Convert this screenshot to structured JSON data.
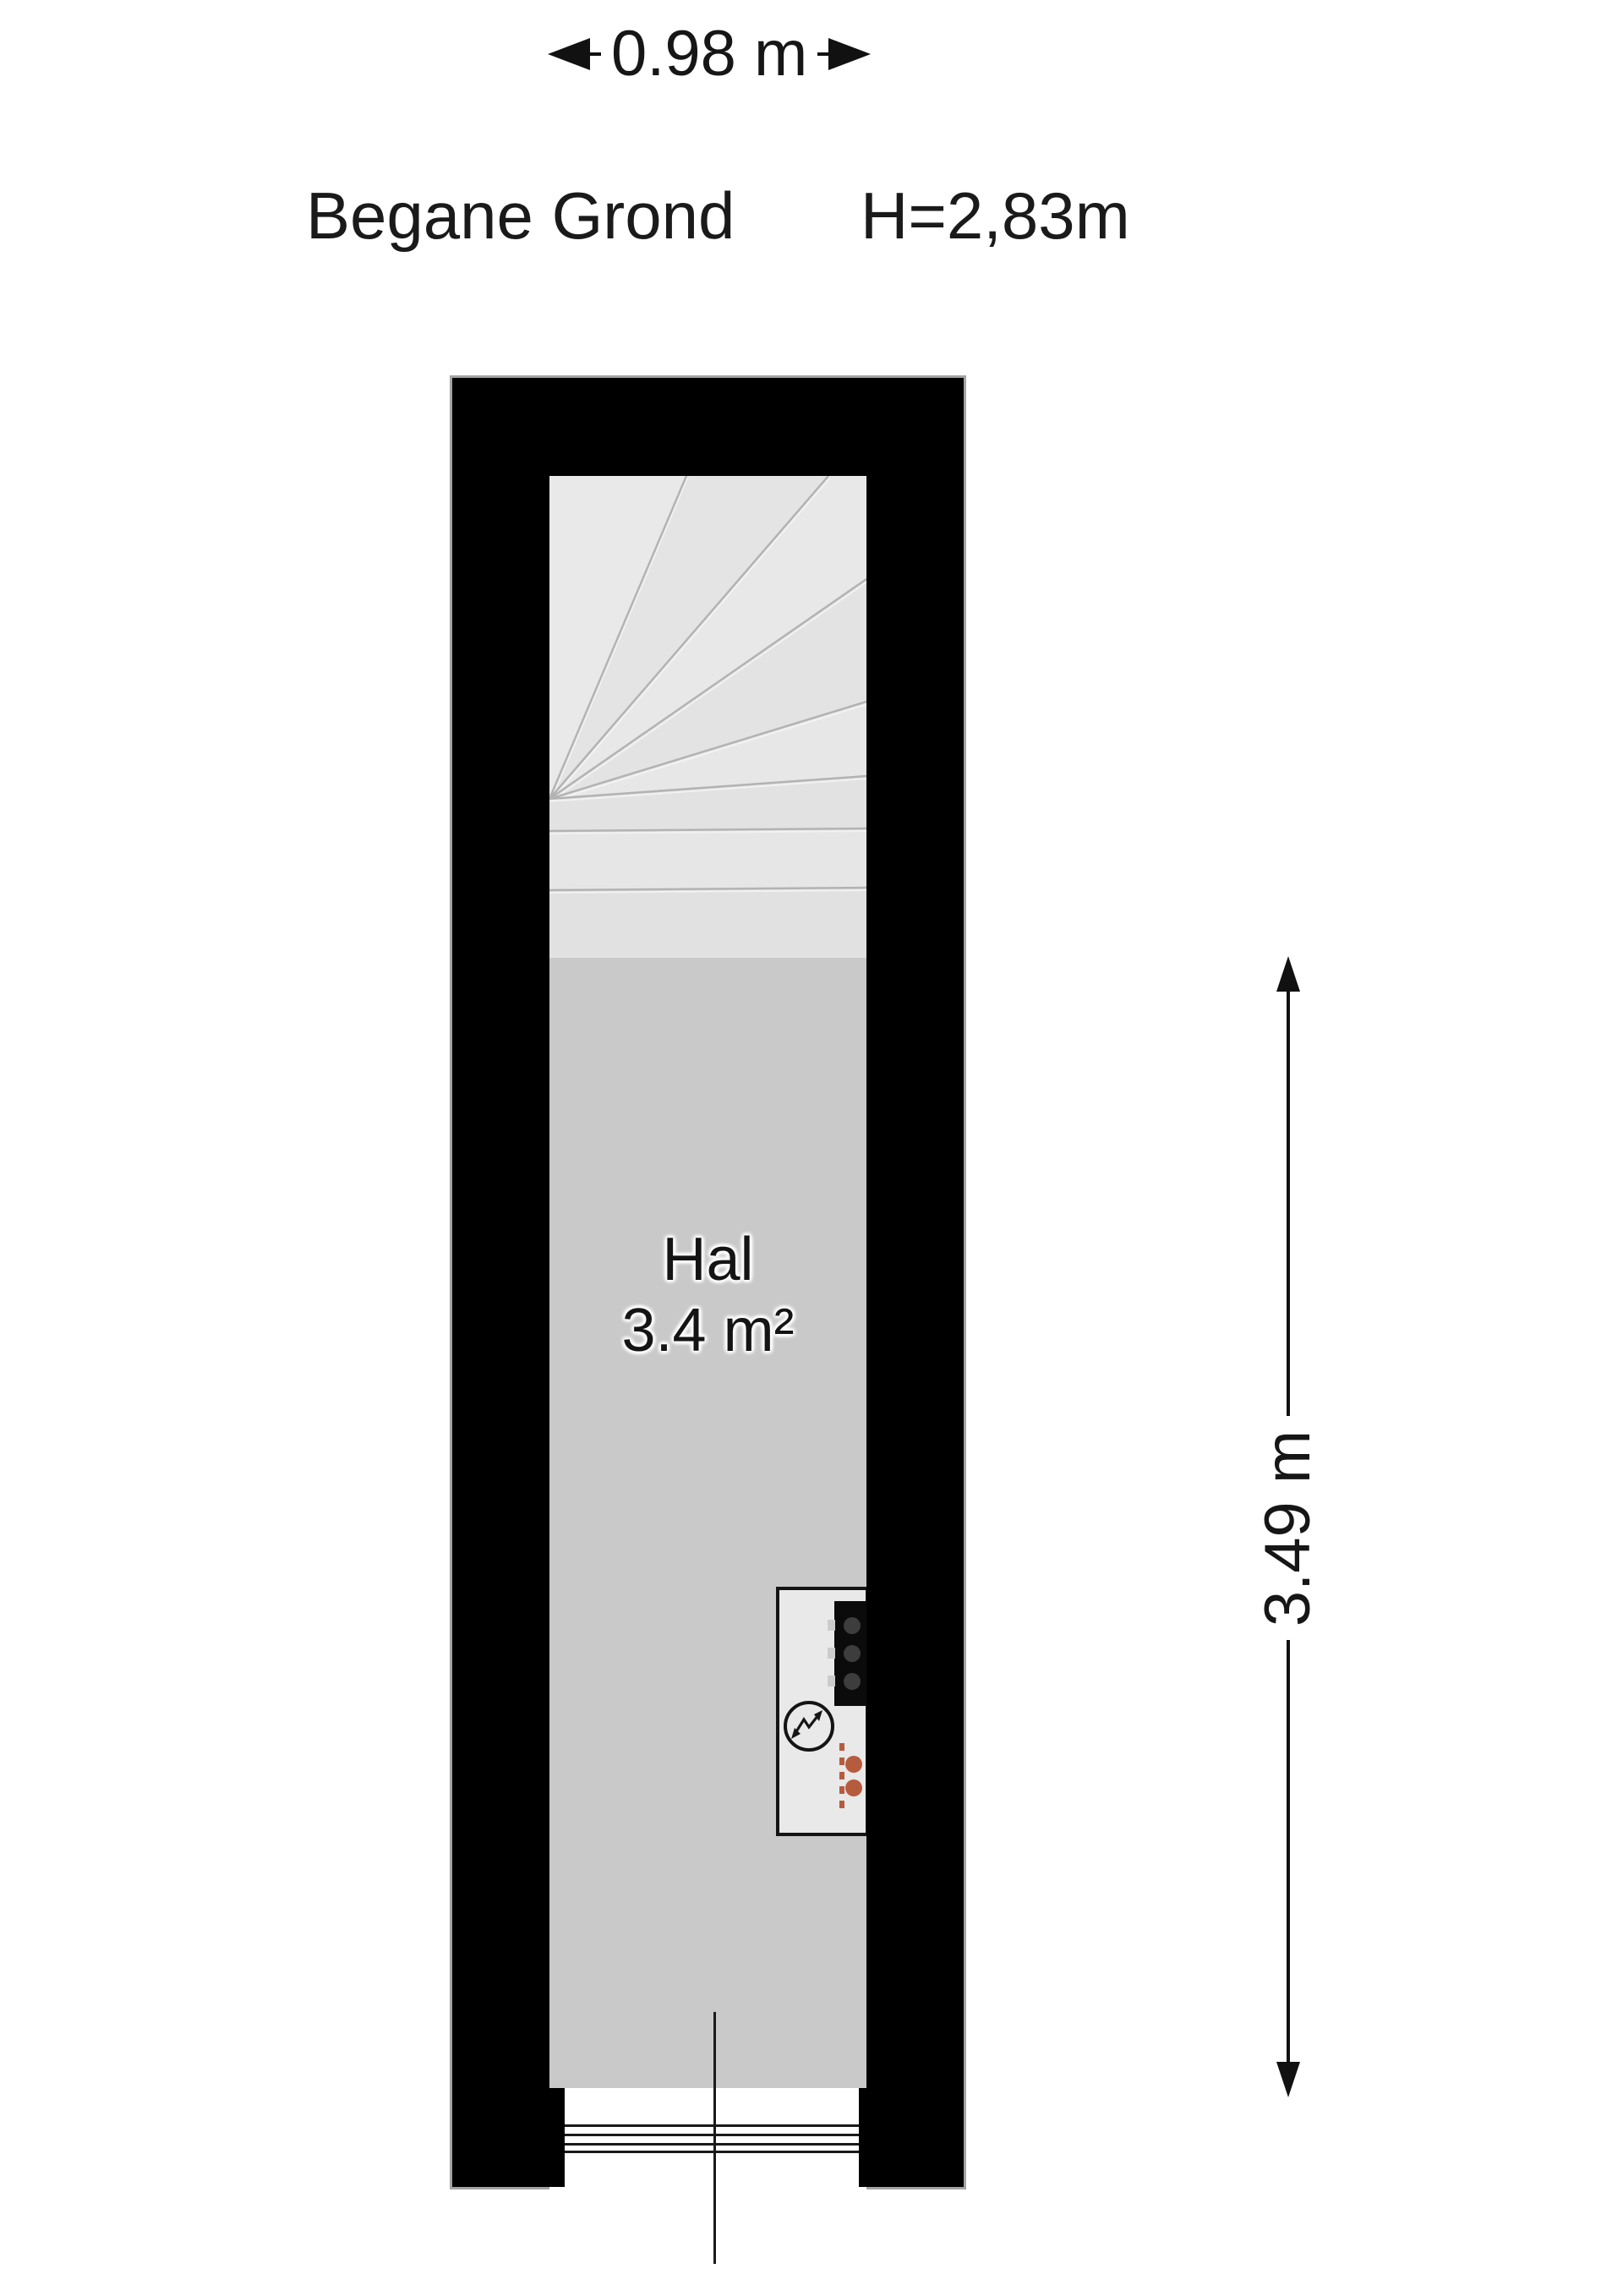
{
  "header": {
    "floor_name": "Begane Grond",
    "ceiling_height": "H=2,83m"
  },
  "dimensions": {
    "width_label": "0.98 m",
    "depth_label": "3.49 m"
  },
  "room": {
    "name": "Hal",
    "area_label": "3.4 m²"
  },
  "icons": {
    "stairs_icon": "winder-stairs",
    "meter_cabinet_icon": "meter-cabinet",
    "fuse_box_icon": "fuse-box",
    "electric_meter_icon": "lightning-bolt-circle",
    "heating_icon": "pipe-connection-dots",
    "entrance_icon": "door-threshold"
  },
  "colors": {
    "wall": "#000000",
    "outline": "#a4a4a4",
    "hall_floor": "#c9c9c9",
    "stair_floor": "#e5e5e5",
    "cabinet_fill": "#e9e9e9",
    "fuse_box": "#0b0b0b",
    "fuse_dots": "#3d3d3d",
    "accent_orange": "#b65c3e",
    "text": "#161616"
  }
}
